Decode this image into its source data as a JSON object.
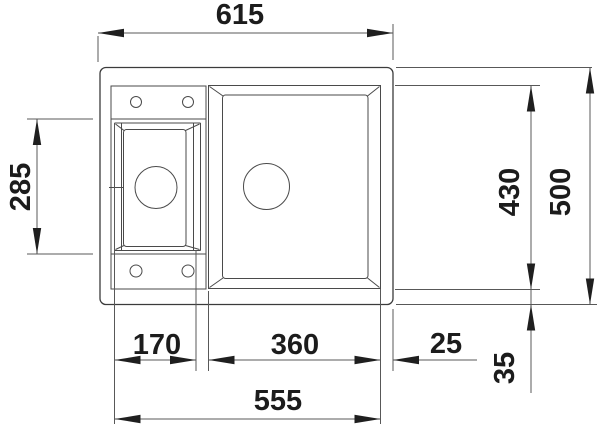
{
  "drawing": {
    "kind": "sink-installation-technical-drawing",
    "dimensions": {
      "overall_width": "615",
      "small_bowl_length": "285",
      "inner_length": "430",
      "overall_length": "500",
      "small_bowl_width": "170",
      "main_bowl_width": "360",
      "edge_gap_right": "25",
      "edge_gap_bottom": "35",
      "bowls_total_width": "555"
    },
    "colors": {
      "background": "#ffffff",
      "object_line": "#3b3b3b",
      "dimension_line": "#585858",
      "text": "#1c1c1c"
    }
  }
}
